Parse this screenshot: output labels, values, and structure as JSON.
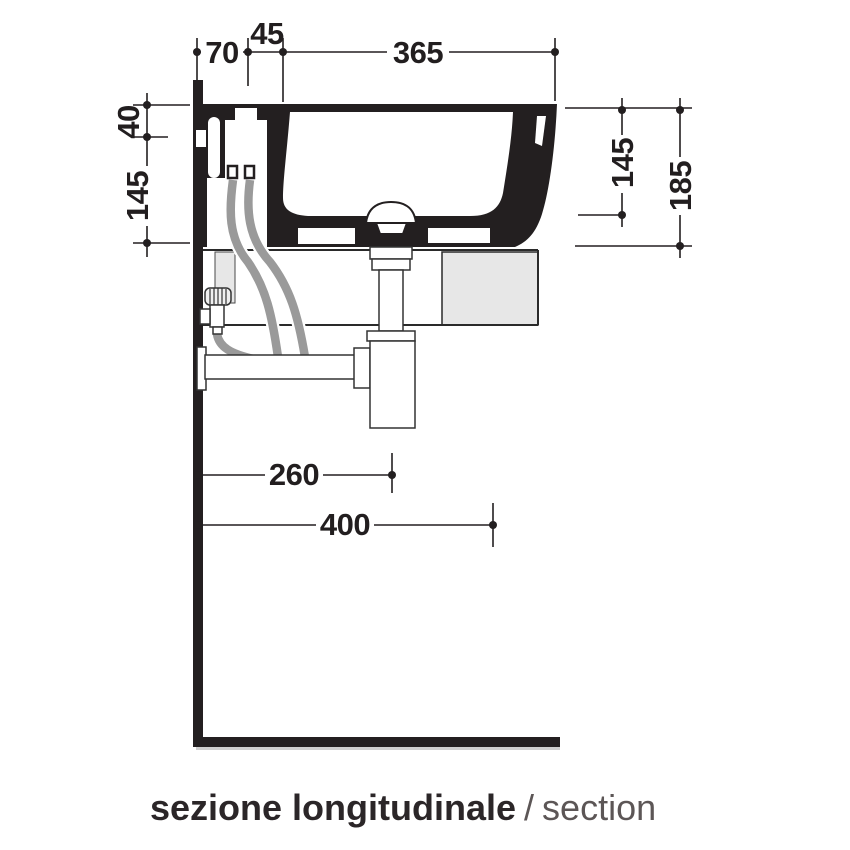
{
  "drawing_title": {
    "italian": "sezione longitudinale",
    "separator": "/",
    "english": "section"
  },
  "dimensions": {
    "top": [
      {
        "label": "70"
      },
      {
        "label": "45"
      },
      {
        "label": "365"
      }
    ],
    "left": [
      {
        "label": "40"
      },
      {
        "label": "145"
      }
    ],
    "right": [
      {
        "label": "145"
      },
      {
        "label": "185"
      }
    ],
    "bottom": [
      {
        "label": "260"
      },
      {
        "label": "400"
      }
    ]
  },
  "colors": {
    "ink": "#231f20",
    "hose": "#9a9a9a",
    "panel": "#e7e7e7",
    "caption_secondary": "#5c5656"
  }
}
